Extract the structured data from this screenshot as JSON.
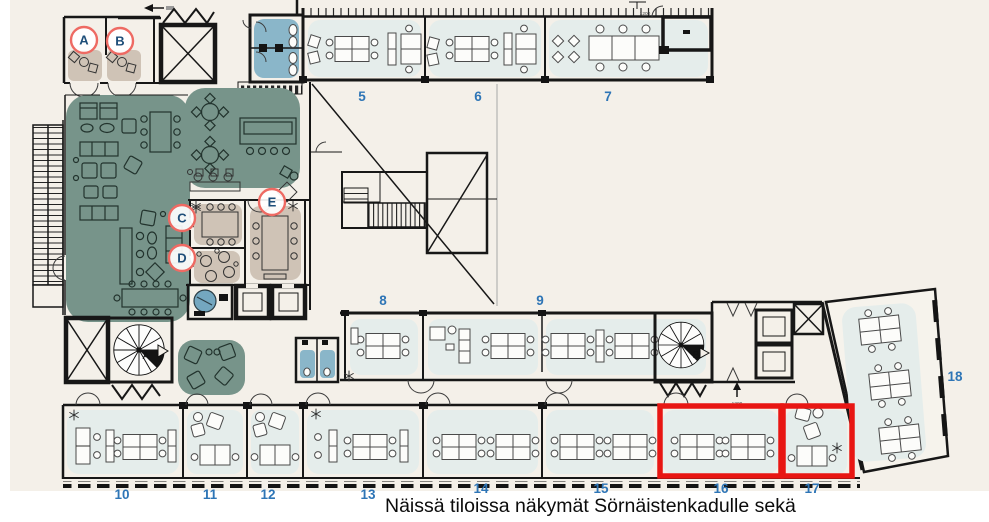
{
  "caption": "Näissä tiloissa näkymät Sörnäistenkadulle sekä",
  "rooms": {
    "r5": "5",
    "r6": "6",
    "r7": "7",
    "r8": "8",
    "r9": "9",
    "r10": "10",
    "r11": "11",
    "r12": "12",
    "r13": "13",
    "r14": "14",
    "r15": "15",
    "r16": "16",
    "r17": "17",
    "r18": "18"
  },
  "markers": {
    "a": "A",
    "b": "B",
    "c": "C",
    "d": "D",
    "e": "E"
  },
  "stairs": {
    "a": "A",
    "b": "B"
  },
  "dims": {
    "top_right": "1200",
    "elevator_lobby": "1200"
  },
  "highlighted_rooms": [
    "16",
    "17"
  ],
  "colors": {
    "background": "#f4f0e9",
    "wall": "#171717",
    "room_fill": "#e5edeb",
    "lounge_green": "#77948a",
    "meeting_tan": "#cfc3b6",
    "wc_blue": "#8ab6c9",
    "highlight_red": "#e81613",
    "marker_ring": "#ee6a63",
    "marker_letter": "#1e4e79",
    "room_number_blue": "#2e75b6"
  }
}
